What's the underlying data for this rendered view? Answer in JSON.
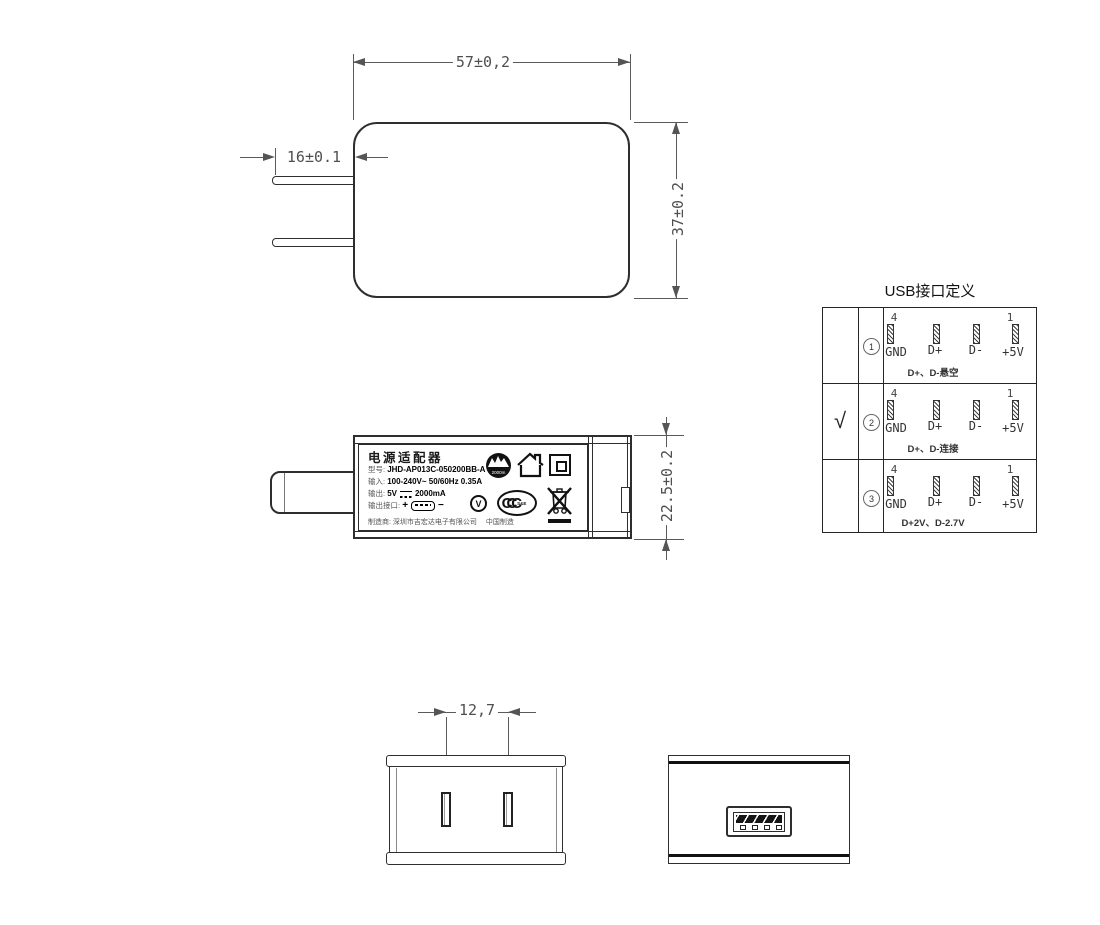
{
  "top_view": {
    "dim_width": "57±0,2",
    "dim_prong_len": "16±0.1",
    "dim_height": "37±0.2"
  },
  "side_view": {
    "dim_thickness": "22.5±0.2",
    "label": {
      "title": "电源适配器",
      "model_label": "型号:",
      "model_value": "JHD-AP013C-050200BB-A",
      "input_label": "输入:",
      "input_value": "100-240V~  50/60Hz  0.35A",
      "output_label": "输出:",
      "output_voltage": "5V",
      "output_current": "2000mA",
      "port_label": "输出接口:",
      "port_plus": "+",
      "port_minus": "−",
      "maker_label": "制造商:",
      "maker_value": "深圳市吉宏达电子有限公司",
      "made_in": "中国制造",
      "altitude_text": "2000m",
      "efficiency_text": "V",
      "ccc_text": "CCC",
      "ccc_sub": "S&E"
    }
  },
  "usb_table": {
    "title": "USB接口定义",
    "pin_num_left": "4",
    "pin_num_right": "1",
    "pin_labels": [
      "GND",
      "D+",
      "D-",
      "+5V"
    ],
    "rows": [
      {
        "checked": "",
        "num": "1",
        "note": "D+、D-悬空"
      },
      {
        "checked": "√",
        "num": "2",
        "note": "D+、D-连接"
      },
      {
        "checked": "",
        "num": "3",
        "note": "D+2V、D-2.7V"
      }
    ]
  },
  "front_view": {
    "dim_pin_spacing": "12,7"
  }
}
